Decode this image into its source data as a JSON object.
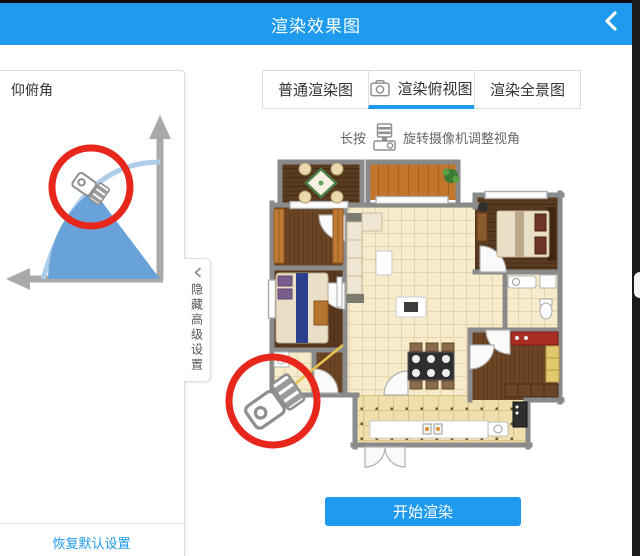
{
  "header": {
    "title": "渲染效果图"
  },
  "left_panel": {
    "pitch_label": "仰俯角",
    "restore_label": "恢复默认设置"
  },
  "advanced_toggle": {
    "label": "隐藏高级设置"
  },
  "tabs": {
    "items": [
      {
        "label": "普通渲染图",
        "active": false
      },
      {
        "label": "渲染俯视图",
        "active": true,
        "icon": "camera-outline-icon"
      },
      {
        "label": "渲染全景图",
        "active": false
      }
    ]
  },
  "instruction": {
    "prefix": "长按",
    "icon": "camera-device-icon",
    "suffix": "旋转摄像机调整视角"
  },
  "render_button": {
    "label": "开始渲染"
  },
  "icons": {
    "back": "chevron-left",
    "advanced_collapse": "chevron-left",
    "active_tab": "camera-outline",
    "instruction": "camera-device",
    "pitch_marker": "camera-3d-in-red-circle",
    "plan_marker": "camera-3d-in-red-circle"
  },
  "colors": {
    "accent": "#1E9AEF",
    "highlight_red": "#E8271C",
    "wall_gray": "#8A8A8A",
    "wedge_blue": "#68A2D8",
    "arc_blue": "#AECDE9",
    "direction_yellow": "#E7C34F"
  }
}
